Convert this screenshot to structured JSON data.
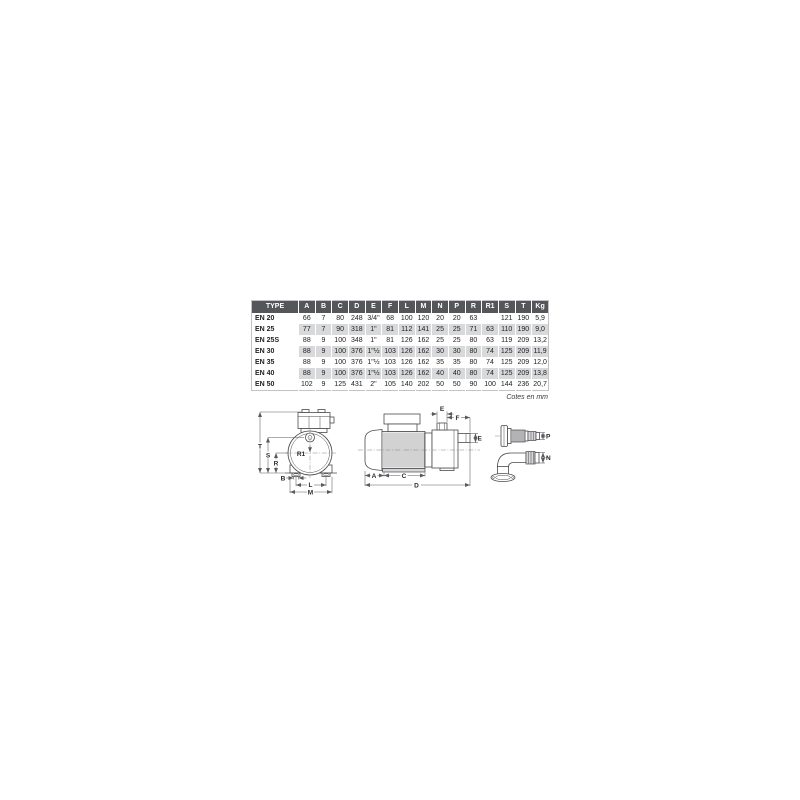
{
  "colors": {
    "header_bg": "#55565a",
    "stripe_bg": "#d8d9db",
    "drawing_line": "#4a4b4d",
    "text": "#222224"
  },
  "table": {
    "columns": [
      "TYPE",
      "A",
      "B",
      "C",
      "D",
      "E",
      "F",
      "L",
      "M",
      "N",
      "P",
      "R",
      "R1",
      "S",
      "T",
      "Kg"
    ],
    "rows": [
      {
        "type": "EN 20",
        "values": [
          "66",
          "7",
          "80",
          "248",
          "3/4\"",
          "68",
          "100",
          "120",
          "20",
          "20",
          "63",
          "",
          "121",
          "190",
          "5,9"
        ]
      },
      {
        "type": "EN 25",
        "values": [
          "77",
          "7",
          "90",
          "318",
          "1\"",
          "81",
          "112",
          "141",
          "25",
          "25",
          "71",
          "63",
          "110",
          "190",
          "9,0"
        ]
      },
      {
        "type": "EN 25S",
        "values": [
          "88",
          "9",
          "100",
          "348",
          "1\"",
          "81",
          "126",
          "162",
          "25",
          "25",
          "80",
          "63",
          "119",
          "209",
          "13,2"
        ]
      },
      {
        "type": "EN 30",
        "values": [
          "88",
          "9",
          "100",
          "376",
          "1\"½",
          "103",
          "126",
          "162",
          "30",
          "30",
          "80",
          "74",
          "125",
          "209",
          "11,9"
        ]
      },
      {
        "type": "EN 35",
        "values": [
          "88",
          "9",
          "100",
          "376",
          "1\"½",
          "103",
          "126",
          "162",
          "35",
          "35",
          "80",
          "74",
          "125",
          "209",
          "12,0"
        ]
      },
      {
        "type": "EN 40",
        "values": [
          "88",
          "9",
          "100",
          "376",
          "1\"½",
          "103",
          "126",
          "162",
          "40",
          "40",
          "80",
          "74",
          "125",
          "209",
          "13,8"
        ]
      },
      {
        "type": "EN 50",
        "values": [
          "102",
          "9",
          "125",
          "431",
          "2\"",
          "105",
          "140",
          "202",
          "50",
          "50",
          "90",
          "100",
          "144",
          "236",
          "20,7"
        ]
      }
    ],
    "note": "Cotes en mm"
  },
  "drawings": {
    "front": {
      "T": "T",
      "S": "S",
      "R": "R",
      "R1": "R1",
      "B": "B",
      "L": "L",
      "M": "M"
    },
    "side": {
      "E_top": "E",
      "F": "F",
      "E_right": "E",
      "A": "A",
      "C": "C",
      "D": "D"
    },
    "fittings": {
      "P": "P",
      "N": "N"
    }
  }
}
